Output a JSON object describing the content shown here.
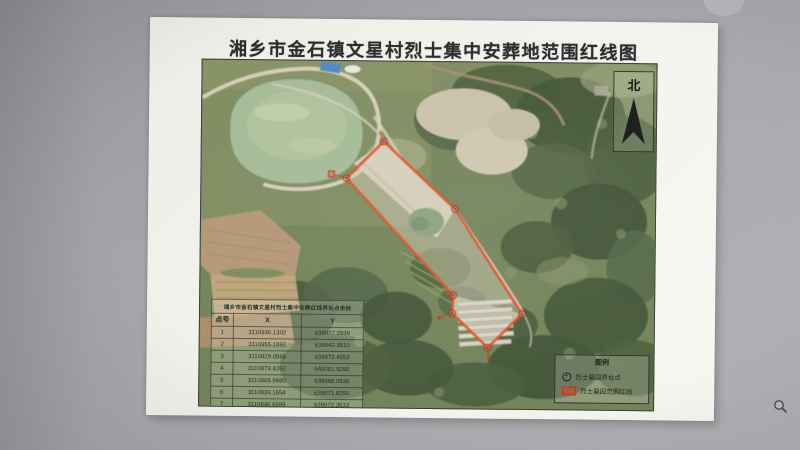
{
  "page": {
    "title": "湘乡市金石镇文星村烈士集中安葬地范围红线图"
  },
  "map": {
    "north_label": "北",
    "red_line_color": "#e0512d",
    "table": {
      "title": "湘乡市金石镇文星村烈士集中安葬红线界址点坐标",
      "columns": [
        "点号",
        "X",
        "Y"
      ],
      "rows": [
        {
          "n": "1",
          "x": "3110936.1302",
          "y": "639927.2939"
        },
        {
          "n": "2",
          "x": "3110955.1892",
          "y": "639942.3510"
        },
        {
          "n": "3",
          "x": "3110929.0568",
          "y": "639972.4553"
        },
        {
          "n": "4",
          "x": "3110879.4262",
          "y": "640001.9290"
        },
        {
          "n": "5",
          "x": "3110865.9880",
          "y": "639988.0836"
        },
        {
          "n": "6",
          "x": "3110839.1654",
          "y": "639971.8256"
        },
        {
          "n": "7",
          "x": "3110846.6699",
          "y": "639972.3533"
        }
      ]
    },
    "legend": {
      "title": "图例",
      "items": [
        {
          "icon": "boundary-point",
          "label": "烈士墓园界址点"
        },
        {
          "icon": "red-line-area",
          "label": "烈士墓园范围红线"
        }
      ]
    }
  },
  "icons": {
    "north": "north-arrow",
    "cursor": "zoom-magnifier"
  }
}
